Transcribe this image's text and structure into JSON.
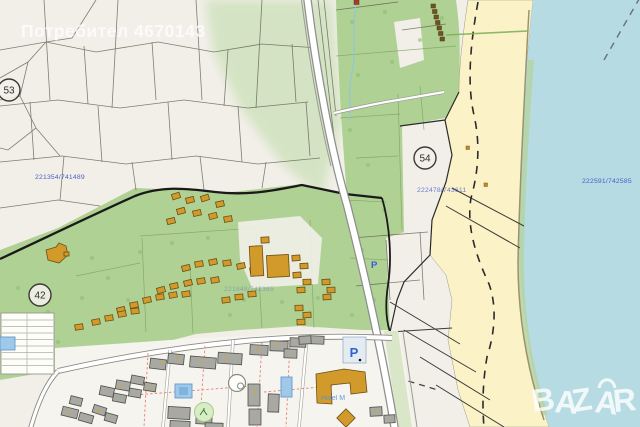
{
  "watermark": {
    "text": "Потребител 4670143"
  },
  "brand": {
    "name": "BAZAR",
    "letters": [
      "B",
      "A",
      "Z",
      "A",
      "R"
    ]
  },
  "map": {
    "zone_markers": [
      {
        "label": "53"
      },
      {
        "label": "42"
      },
      {
        "label": "54"
      }
    ],
    "coordinate_labels": [
      {
        "text": "221354/741489"
      },
      {
        "text": "221848/742365"
      },
      {
        "text": "222478/743611"
      },
      {
        "text": "222591/742585"
      }
    ],
    "labels": {
      "hotel": "Hotel M",
      "parking_lot": "P",
      "parking_road": "P"
    }
  },
  "colors": {
    "base": "#f2efe9",
    "sea": "#b7dbe3",
    "beach": "#fbf2c8",
    "green": "#afd194",
    "green-pale": "#cfe2bd",
    "parcel-line": "#5a564c",
    "building-orange": "#d19a2b",
    "building-gray": "#a9a9a4",
    "label-blue": "#4a5fc5",
    "road-casing": "#8e8e8e",
    "boundary-black": "#1a1a1a",
    "pool-blue": "#9ec9e8",
    "path-red": "#e26b5e"
  }
}
